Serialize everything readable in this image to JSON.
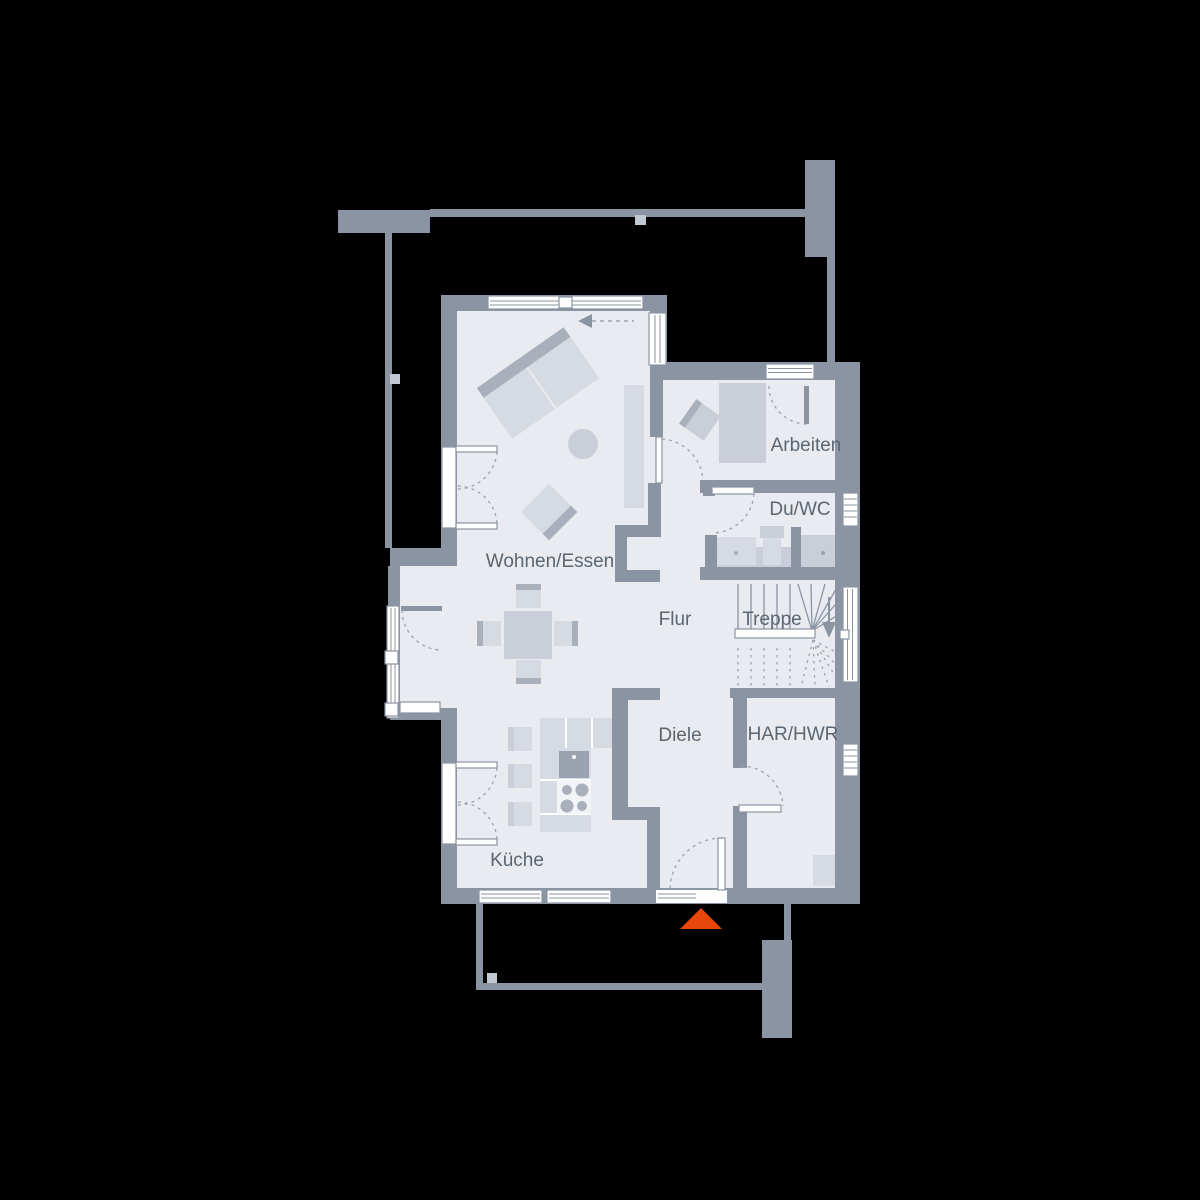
{
  "plan": {
    "type": "floor-plan",
    "rooms": [
      {
        "id": "wohnen-essen",
        "label": "Wohnen/Essen"
      },
      {
        "id": "kueche",
        "label": "Küche"
      },
      {
        "id": "flur",
        "label": "Flur"
      },
      {
        "id": "treppe",
        "label": "Treppe"
      },
      {
        "id": "diele",
        "label": "Diele"
      },
      {
        "id": "har-hwr",
        "label": "HAR/HWR"
      },
      {
        "id": "arbeiten",
        "label": "Arbeiten"
      },
      {
        "id": "du-wc",
        "label": "Du/WC"
      }
    ]
  },
  "colors": {
    "background": "#000000",
    "wall": "#8A94A2",
    "floor": "#E9EBF0",
    "furniture_light": "#D6DAE2",
    "furniture_medium": "#C9CED8",
    "furniture_dark": "#A9B0BC",
    "fixture_dark": "#9BA3B1",
    "window_white": "#FFFFFF",
    "label_text": "#5C6673",
    "dashed_line": "#9AA3AF",
    "marker_light": "#C2C8D1",
    "entrance_arrow": "#E8470C"
  }
}
